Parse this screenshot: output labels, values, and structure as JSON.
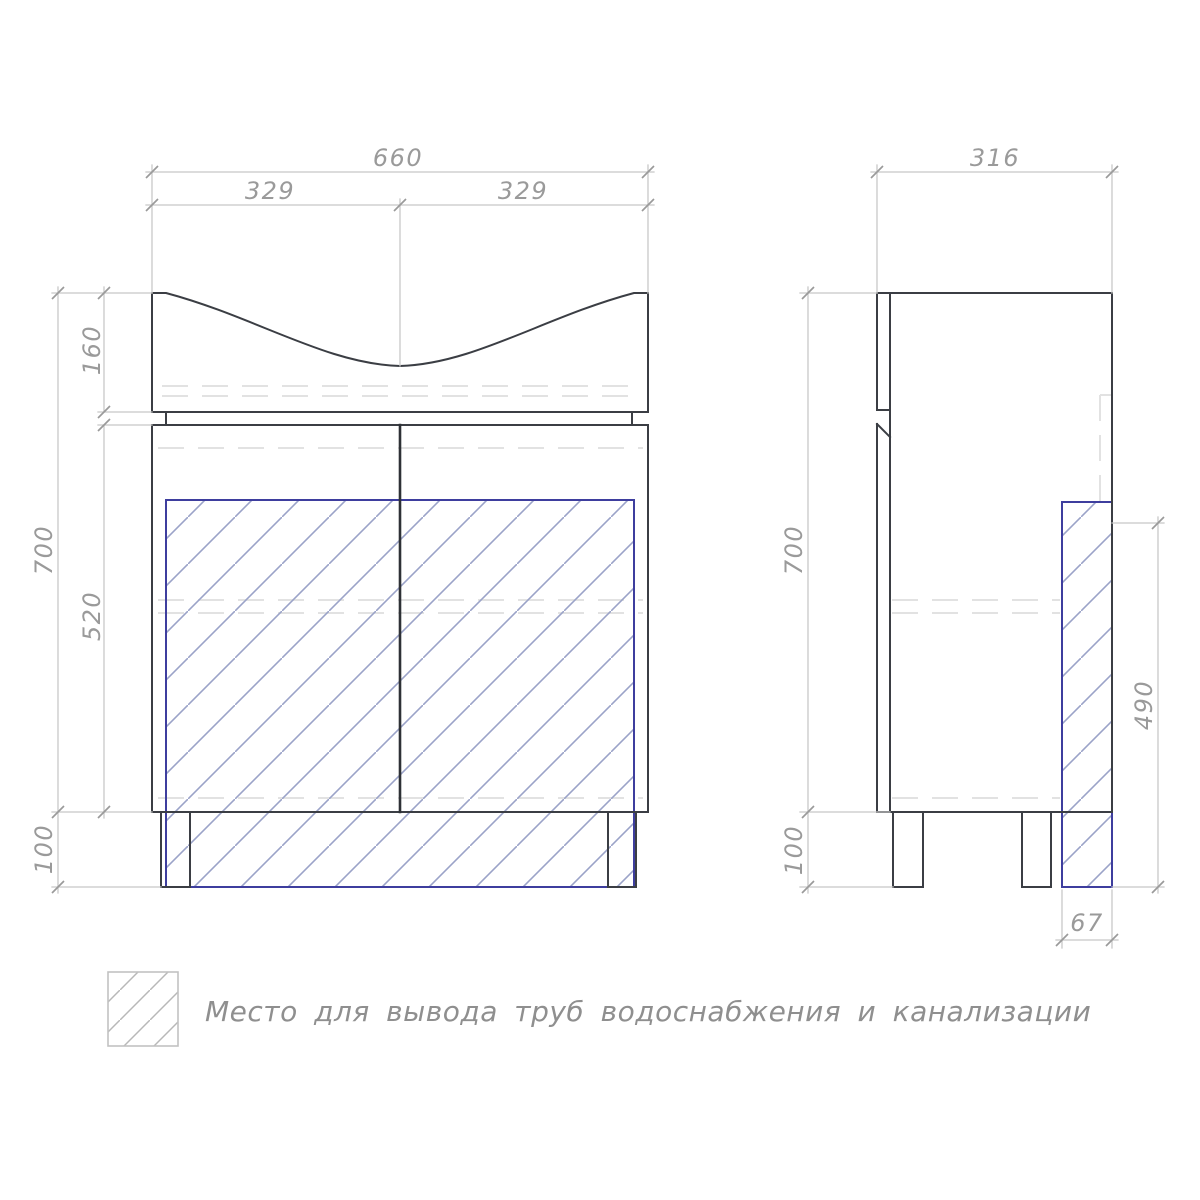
{
  "front_view": {
    "width_total": "660",
    "width_half_left": "329",
    "width_half_right": "329",
    "basin_height": "160",
    "total_height": "700",
    "cabinet_height": "520",
    "legs_height": "100"
  },
  "side_view": {
    "depth_total": "316",
    "total_height": "700",
    "legs_height": "100",
    "pipe_zone_height": "490",
    "pipe_zone_depth": "67"
  },
  "legend": {
    "label": "Место для вывода труб водоснабжения и канализации"
  },
  "colors": {
    "outline": "#3b3e44",
    "dimension_line": "#c8c8c8",
    "dimension_text": "#9a9a9a",
    "hidden_line": "#e2e2e2",
    "pipe_zone_border": "#3e3e9e",
    "pipe_zone_hatch": "#9ba3c8",
    "legend_hatch": "#b8b8b8"
  }
}
